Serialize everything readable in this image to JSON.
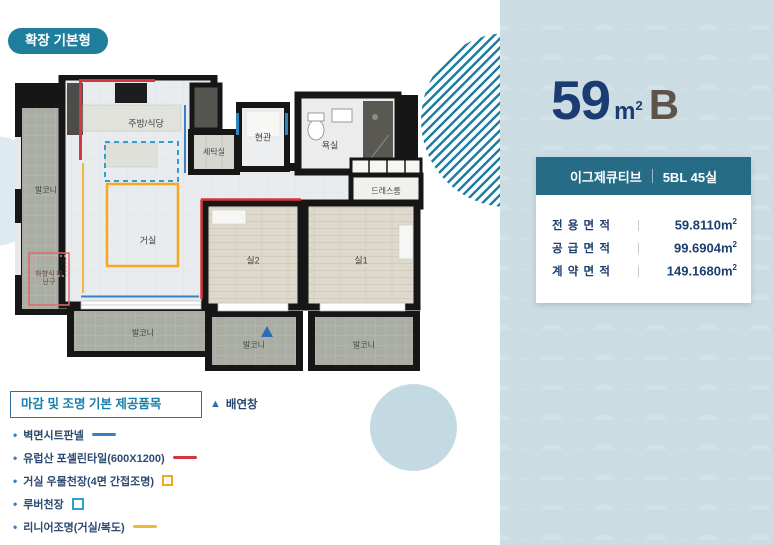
{
  "badge": {
    "label": "확장 기본형"
  },
  "panel": {
    "title": {
      "number": "59",
      "unit_base": "m",
      "unit_sup": "2",
      "type": "B"
    },
    "info_box": {
      "header": {
        "name": "이그제큐티브",
        "block": "5BL 45실"
      },
      "rows": [
        {
          "label": "전 용 면 적",
          "value": "59.8110",
          "unit_base": "m",
          "unit_sup": "2"
        },
        {
          "label": "공 급 면 적",
          "value": "99.6904",
          "unit_base": "m",
          "unit_sup": "2"
        },
        {
          "label": "계 약 면 적",
          "value": "149.1680",
          "unit_base": "m",
          "unit_sup": "2"
        }
      ]
    }
  },
  "legend": {
    "title": "마감 및 조명 기본 제공품목",
    "vent": {
      "icon": "up-triangle-icon",
      "label": "배연창"
    },
    "items": [
      {
        "label": "벽면시트판넬",
        "swatch": "blue-line"
      },
      {
        "label": "유럽산 포셀린타일(600X1200)",
        "swatch": "red-line"
      },
      {
        "label": "거실 우물천장(4면 간접조명)",
        "swatch": "orange-square-outline"
      },
      {
        "label": "루버천장",
        "swatch": "blue-dashed-square"
      },
      {
        "label": "리니어조명(거실/복도)",
        "swatch": "yellow-line"
      }
    ]
  },
  "plan": {
    "rooms": {
      "kitchen_dining": "주방/식당",
      "laundry": "세탁실",
      "entrance": "현관",
      "bathroom": "욕실",
      "dressroom": "드레스룸",
      "living": "거실",
      "room2": "실2",
      "room1": "실1",
      "balcony": "발코니",
      "escape_hatch": "하향식 피난구"
    }
  },
  "colors": {
    "badge_teal": "#1e7e9c",
    "info_header_teal": "#266c86",
    "navy_text": "#1c3e6e",
    "title_navy": "#1b3c72",
    "type_brown": "#5d5348",
    "panel_bg": "#cbdce3",
    "stripe_teal": "#1f7fa2",
    "legend_title_blue": "#1780ad",
    "sheet_panel_blue": "#3a7fc1",
    "porcelain_red": "#d6363f",
    "coffered_orange": "#f5a623",
    "louver_blue": "#2f9fd0",
    "linear_yellow": "#f0b73e",
    "vent_blue": "#2b6cb8"
  }
}
